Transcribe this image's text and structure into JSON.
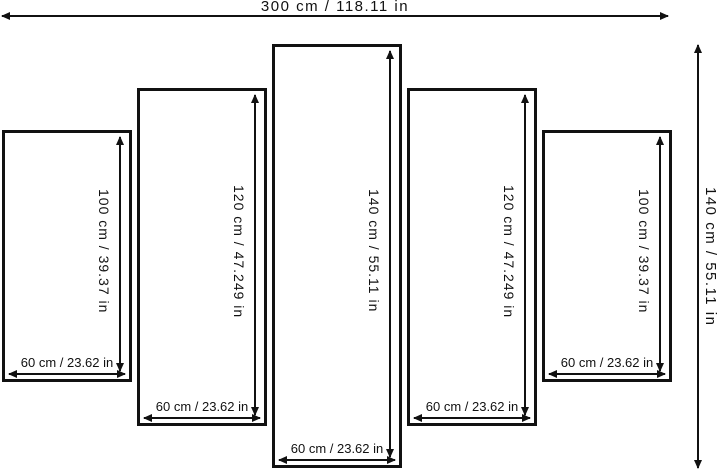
{
  "diagram": {
    "overall_width_label": "300 cm / 118.11 in",
    "overall_height_label": "140 cm / 55.11 in",
    "panels": [
      {
        "height_label": "100 cm / 39.37 in",
        "width_label": "60 cm / 23.62 in"
      },
      {
        "height_label": "120 cm / 47.249 in",
        "width_label": "60 cm / 23.62 in"
      },
      {
        "height_label": "140 cm / 55.11 in",
        "width_label": "60 cm / 23.62 in"
      },
      {
        "height_label": "120 cm / 47.249 in",
        "width_label": "60 cm / 23.62 in"
      },
      {
        "height_label": "100 cm / 39.37 in",
        "width_label": "60 cm / 23.62 in"
      }
    ],
    "colors": {
      "line": "#111111",
      "background": "#ffffff"
    }
  }
}
